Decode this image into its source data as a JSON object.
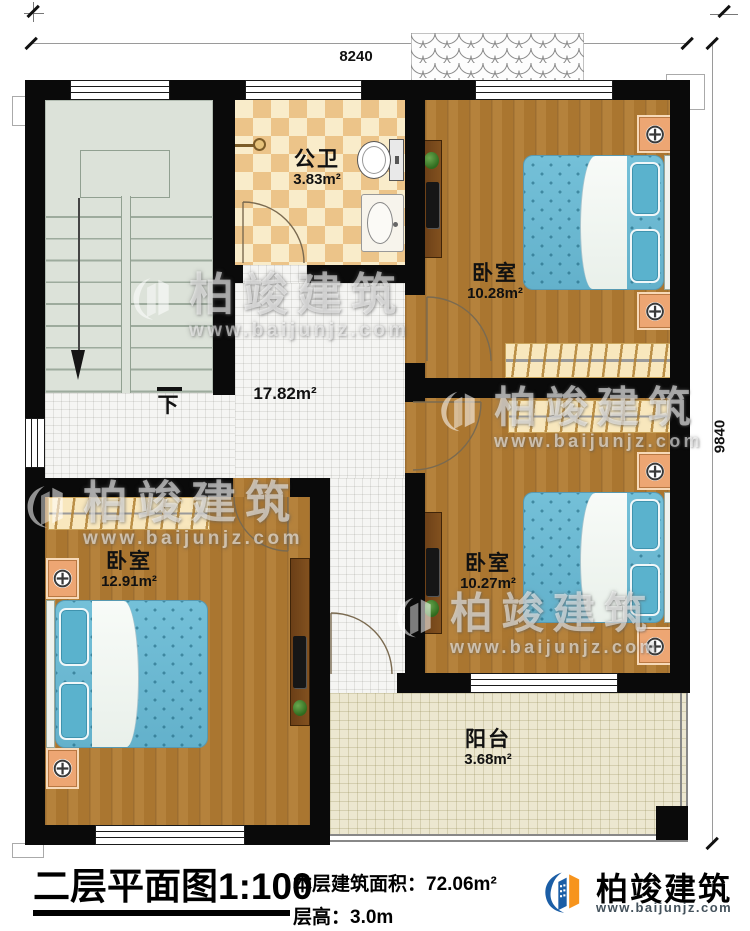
{
  "dimensions": {
    "top_width_mm": "8240",
    "right_height_mm": "9840"
  },
  "rooms": {
    "bathroom": {
      "name": "公卫",
      "area": "3.83m²"
    },
    "bedroom_top_right": {
      "name": "卧室",
      "area": "10.28m²"
    },
    "bedroom_middle_right": {
      "name": "卧室",
      "area": "10.27m²"
    },
    "bedroom_bottom_left": {
      "name": "卧室",
      "area": "12.91m²"
    },
    "hall": {
      "area": "17.82m²"
    },
    "balcony": {
      "name": "阳台",
      "area": "3.68m²"
    },
    "stairs": {
      "direction_label": "下"
    }
  },
  "title_block": {
    "plan_title": "二层平面图",
    "scale": "1:100",
    "floor_area_label": "本层建筑面积：",
    "floor_area_value": "72.06m²",
    "floor_height_label": "层高：",
    "floor_height_value": "3.0m"
  },
  "brand": {
    "name": "柏竣建筑",
    "website": "www.baijunjz.com"
  },
  "watermark": {
    "text": "柏竣建筑",
    "website": "www.baijunjz.com"
  },
  "icons": {
    "lamp": "⊕"
  },
  "colors": {
    "wall": "#0a0a0a",
    "wood_floor": "#b0823c",
    "hall_tile": "#f5f5f3",
    "balcony_tile": "#ece7d0",
    "checker_dark": "#ecc489",
    "checker_light": "#f9ecca",
    "stair_floor": "#dce2d9",
    "bed_blue": "#6cb9d2",
    "nightstand_orange": "#eda673",
    "wardrobe_cream": "#f8e7bd",
    "brand_blue": "#1b5ea6",
    "brand_orange": "#f7941d"
  }
}
